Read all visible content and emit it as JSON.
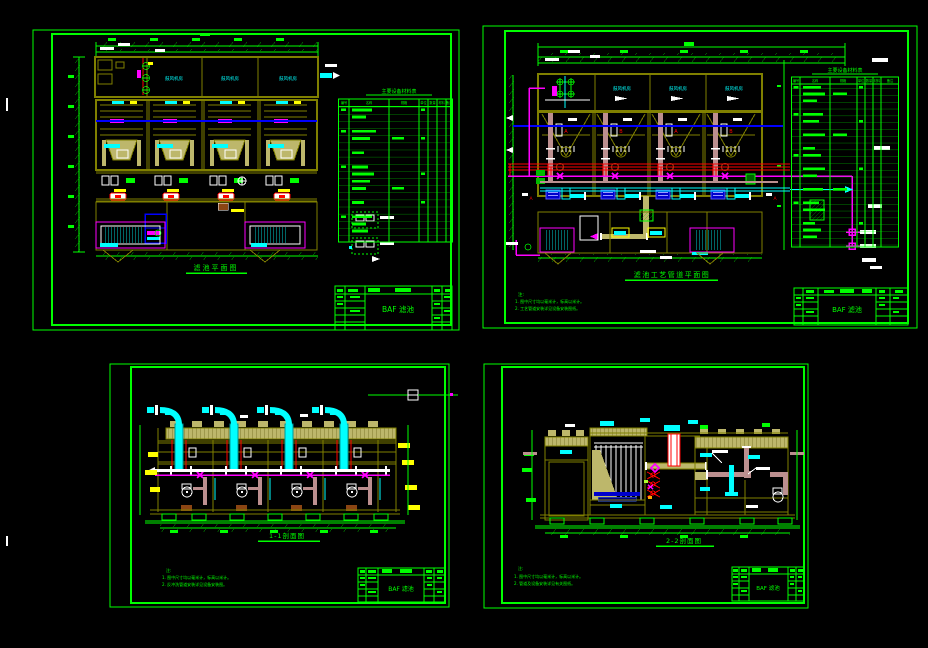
{
  "app": {
    "background": "#000000"
  },
  "palette": {
    "frame_green": "#00FF00",
    "wall_olive": "#808000",
    "deck_khaki": "#BDB76B",
    "pipe_red": "#FF0000",
    "pipe_magenta": "#FF00FF",
    "pipe_cyan": "#00FFFF",
    "line_blue": "#0000FF",
    "pipe_rosybrown": "#BC8F8F",
    "pump_blue": "#0000CD",
    "fitting_brown": "#8B4513",
    "highlight_yellow": "#FFFF00",
    "annotation_white": "#FFFFFF"
  },
  "sheets": [
    {
      "id": "plan-layout",
      "caption": "滤池平面图",
      "rooms": [
        "鼓风机房",
        "鼓风机房",
        "鼓风机房"
      ],
      "table": {
        "title": "主要设备材料表",
        "headers": [
          "编号",
          "名称",
          "规格",
          "单位",
          "数量",
          "材料",
          "备注"
        ],
        "row_count": 20
      },
      "title_block": {
        "title": "BAF 滤池"
      }
    },
    {
      "id": "pipe-plan",
      "caption": "滤池工艺管道平面图",
      "rooms": [
        "鼓风机房",
        "鼓风机房",
        "鼓风机房"
      ],
      "cells": [
        "A",
        "B",
        "A",
        "B"
      ],
      "section_markers": [
        "A",
        "A"
      ],
      "notes": [
        "注:",
        "1. 图中尺寸均以毫米计，标高以米计。",
        "2. 工艺管道安装详见设备安装图纸。"
      ],
      "table": {
        "title": "主要设备材料表",
        "headers": [
          "编号",
          "名称",
          "规格",
          "单位",
          "数量",
          "材料",
          "备注"
        ],
        "row_count": 24
      },
      "title_block": {
        "title": "BAF 滤池"
      }
    },
    {
      "id": "section-1-1",
      "caption": "1-1剖面图",
      "notes": [
        "注:",
        "1. 图中尺寸均以毫米计，标高以米计。",
        "2. 反冲洗管道安装详见设备安装图。"
      ],
      "title_block": {
        "title": "BAF 滤池"
      }
    },
    {
      "id": "section-2-2",
      "caption": "2-2剖面图",
      "notes": [
        "注:",
        "1. 图中尺寸均以毫米计，标高以米计。",
        "2. 管道及设备安装详见有关图纸。"
      ],
      "title_block": {
        "title": "BAF 滤池"
      }
    }
  ]
}
